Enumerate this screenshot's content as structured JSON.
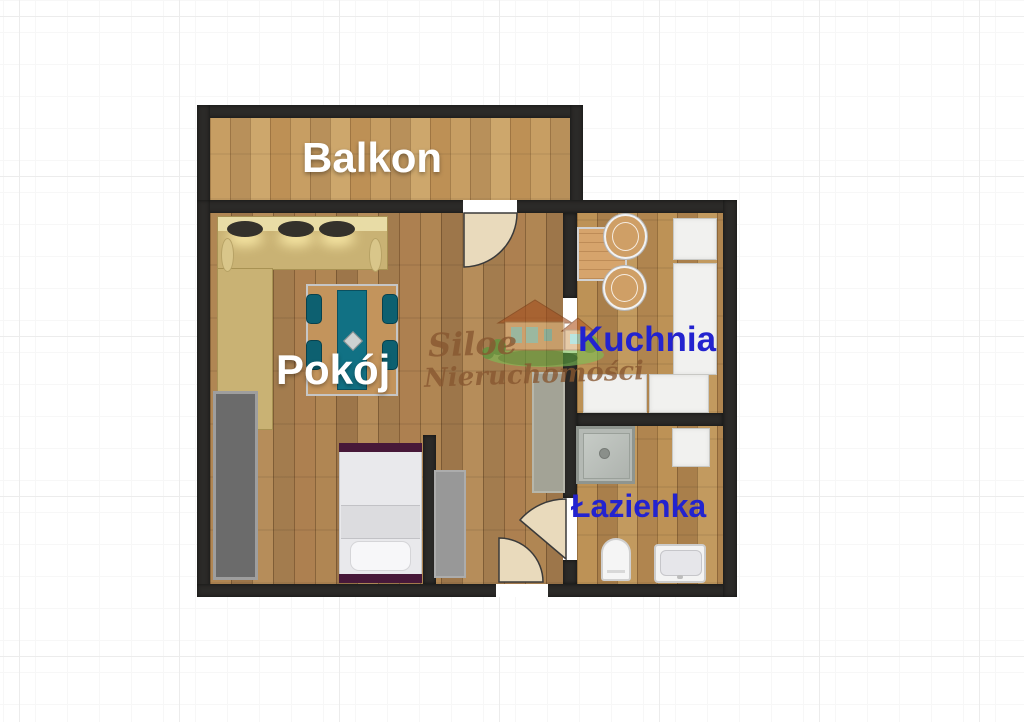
{
  "title": "Apartment floor plan",
  "rooms": {
    "balcony": {
      "label": "Balkon"
    },
    "room": {
      "label": "Pokój"
    },
    "kitchen": {
      "label": "Kuchnia"
    },
    "bathroom": {
      "label": "Łazienka"
    }
  },
  "watermark": {
    "line1": "Siloe",
    "line2": "Nieruchomości"
  },
  "colors": {
    "wall": "#2b2a28",
    "label_white": "#ffffff",
    "label_blue": "#2323cf",
    "watermark_brown": "#86562f",
    "floor_room": "#ab8150",
    "floor_balcony": "#c49a61",
    "sofa_beige": "#c9b274",
    "table_runner_teal": "#117184",
    "chair_teal": "#0d6070",
    "bed_frame_maroon": "#471839",
    "wardrobe_gray": "#6b6b6b",
    "counter_white": "#f1f1ef",
    "door_wedge": "#e9dabc",
    "grass_green": "#6db34a"
  },
  "furniture": [
    "corner-sofa",
    "dining-table",
    "dining-chairs",
    "bed",
    "wardrobe",
    "hall-rug",
    "hall-rug-2",
    "kitchen-table",
    "kitchen-chairs",
    "kitchen-counters",
    "shower",
    "bathroom-cabinet",
    "toilet",
    "sink"
  ],
  "doors": [
    "balcony-door",
    "kitchen-opening",
    "bathroom-door",
    "entrance-door"
  ]
}
